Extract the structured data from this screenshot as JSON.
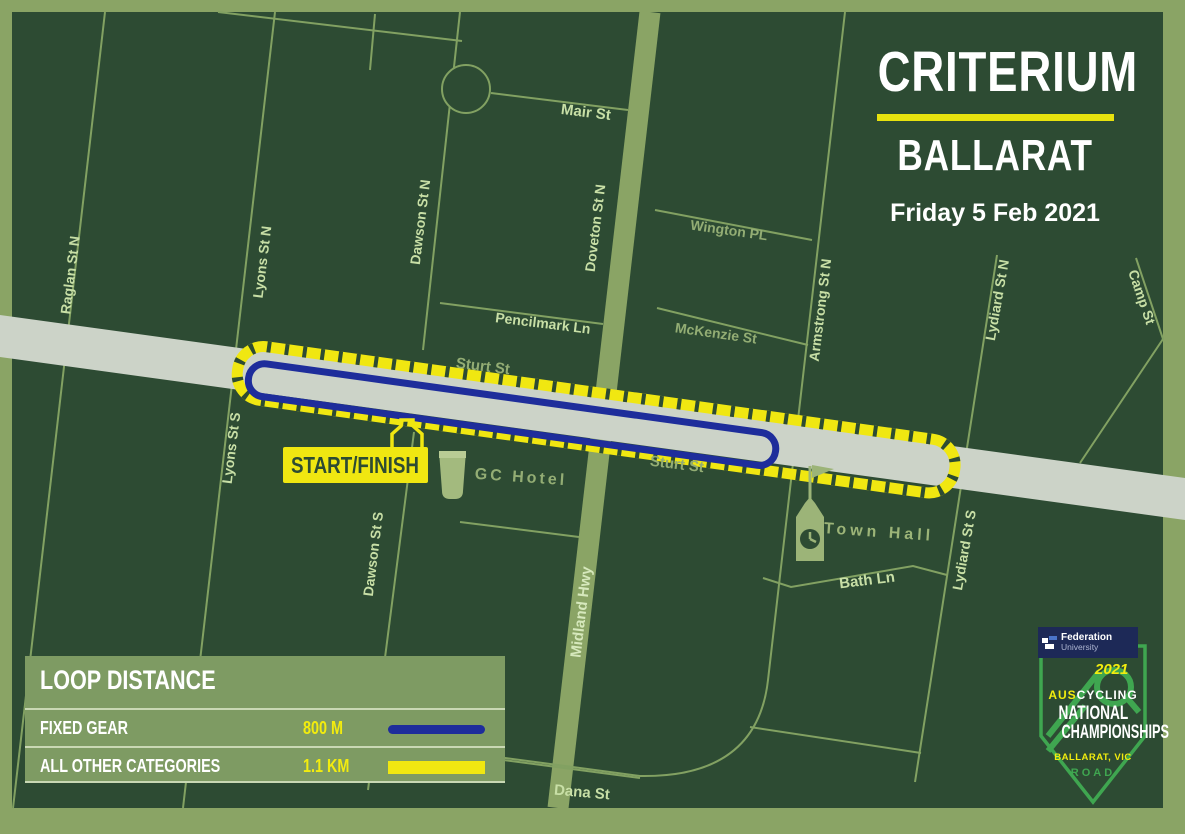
{
  "title": {
    "event": "CRITERIUM",
    "location": "BALLARAT",
    "date": "Friday 5 Feb 2021"
  },
  "map": {
    "streets": {
      "mair": "Mair St",
      "raglan_n": "Raglan St N",
      "lyons_n": "Lyons St N",
      "lyons_s": "Lyons St S",
      "dawson_n": "Dawson St N",
      "dawson_s": "Dawson St S",
      "doveton_n": "Doveton St N",
      "midland": "Midland Hwy",
      "pencilmark": "Pencilmark Ln",
      "wington": "Wington PL",
      "mckenzie": "McKenzie St",
      "armstrong_n": "Armstrong St N",
      "lydiard_n": "Lydiard St N",
      "lydiard_s": "Lydiard St S",
      "camp": "Camp St",
      "sturt_upper": "Sturt St",
      "sturt_lower": "Sturt St",
      "bath": "Bath Ln",
      "dana": "Dana St"
    },
    "pois": {
      "start_finish": "START/FINISH",
      "gc_hotel": "GC Hotel",
      "town_hall": "Town Hall"
    }
  },
  "legend": {
    "header": "LOOP DISTANCE",
    "rows": [
      {
        "label": "FIXED GEAR",
        "value": "800 M",
        "color": "#1e2d9b"
      },
      {
        "label": "ALL OTHER CATEGORIES",
        "value": "1.1 KM",
        "color": "#f0e711"
      }
    ]
  },
  "logo": {
    "university_line1": "Federation",
    "university_line2": "University",
    "year": "2021",
    "org_prefix": "AUS",
    "org_suffix": "CYCLING",
    "line1": "NATIONAL",
    "line2": "CHAMPIONSHIPS",
    "location": "BALLARAT, VIC",
    "discipline": "ROAD"
  },
  "colors": {
    "border_olive": "#8aa465",
    "map_background": "#2d4b33",
    "road_gray": "#ccd3c8",
    "course_yellow": "#f0e711",
    "fixed_gear_blue": "#1e2d9b",
    "street_line": "#82a162",
    "label_bright": "#c8dfa6",
    "label_dim": "#93ad74",
    "poi_olive": "#9cb478",
    "legend_background": "#7e9b63",
    "banner_navy": "#1d2957",
    "logo_green": "#3fa650"
  }
}
